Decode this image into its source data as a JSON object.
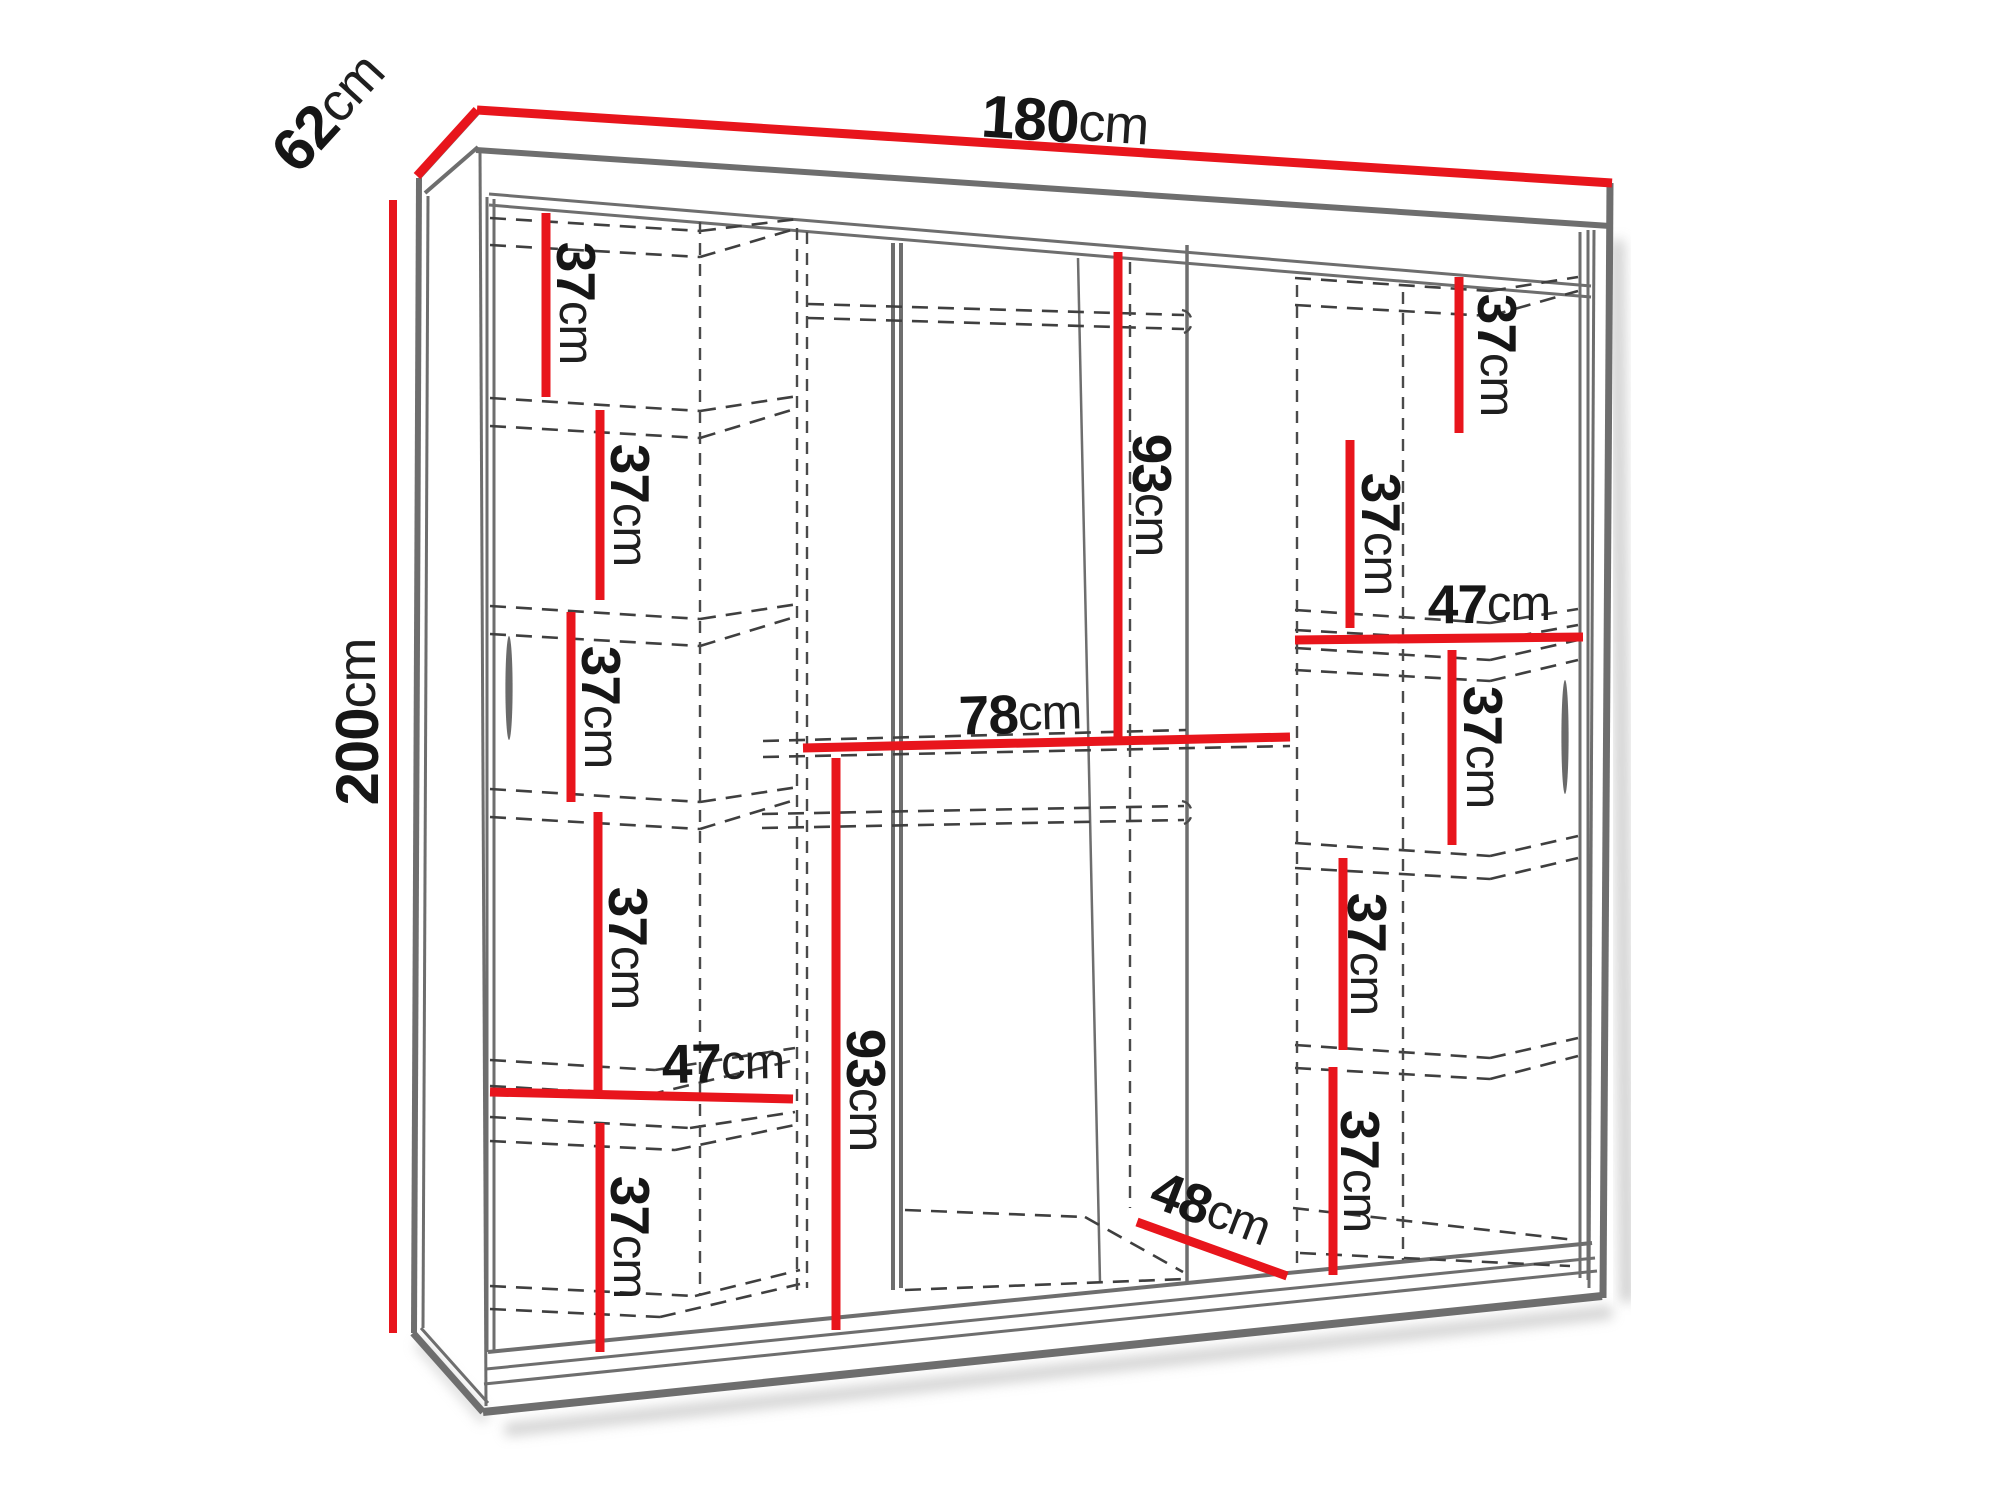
{
  "diagram_type": "wardrobe-dimension-drawing",
  "colors": {
    "dimension_red": "#e8151c",
    "structure_gray": "#6e6e6e",
    "dashed_gray": "#3f3f3f",
    "label_text": "#161616"
  },
  "overall": {
    "width": {
      "v": "180",
      "u": "cm"
    },
    "depth": {
      "v": "62",
      "u": "cm"
    },
    "height": {
      "v": "200",
      "u": "cm"
    }
  },
  "left_column": [
    {
      "v": "37",
      "u": "cm"
    },
    {
      "v": "37",
      "u": "cm"
    },
    {
      "v": "37",
      "u": "cm"
    },
    {
      "v": "37",
      "u": "cm"
    },
    {
      "v": "47",
      "u": "cm"
    },
    {
      "v": "37",
      "u": "cm"
    }
  ],
  "middle": {
    "upper_height": {
      "v": "93",
      "u": "cm"
    },
    "shelf_width": {
      "v": "78",
      "u": "cm"
    },
    "lower_height": {
      "v": "93",
      "u": "cm"
    },
    "base_depth": {
      "v": "48",
      "u": "cm"
    }
  },
  "right_column": [
    {
      "v": "37",
      "u": "cm"
    },
    {
      "v": "37",
      "u": "cm"
    },
    {
      "v": "47",
      "u": "cm"
    },
    {
      "v": "37",
      "u": "cm"
    },
    {
      "v": "37",
      "u": "cm"
    },
    {
      "v": "37",
      "u": "cm"
    }
  ]
}
